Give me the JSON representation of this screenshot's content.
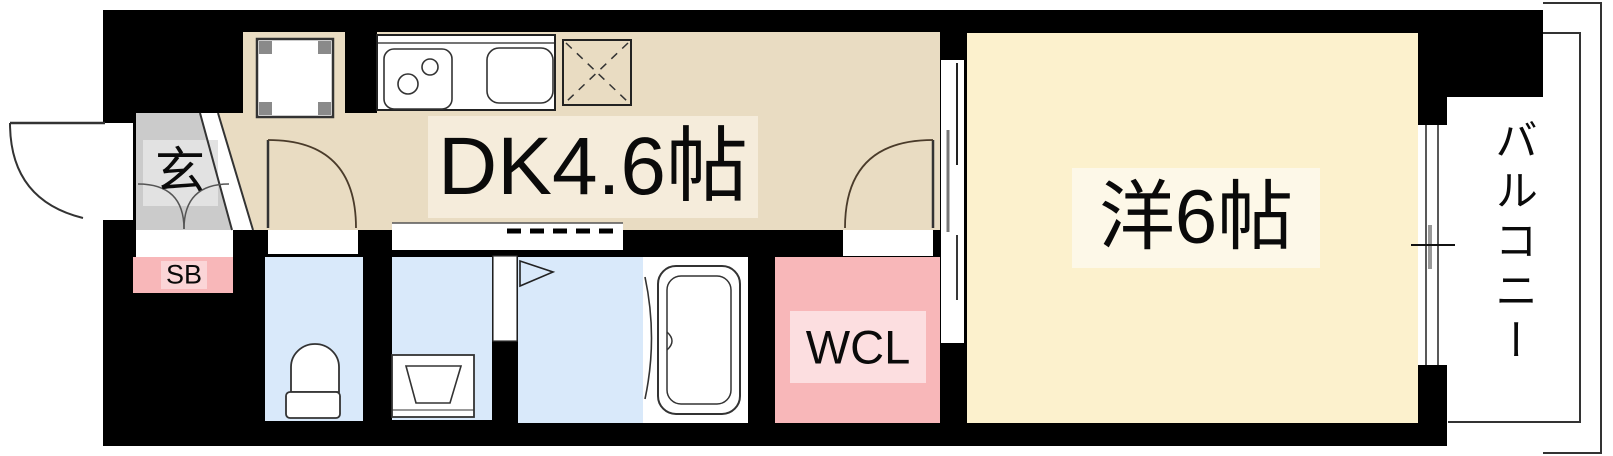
{
  "plan_title": "1DK apartment floor plan",
  "rooms": {
    "genkan": {
      "label": "玄"
    },
    "shoe_box": {
      "label": "SB"
    },
    "dk": {
      "label": "DK4.6帖"
    },
    "wcl": {
      "label": "WCL"
    },
    "western": {
      "label": "洋6帖"
    },
    "balcony": {
      "label": "バルコニー"
    }
  },
  "colors": {
    "wall": "#000000",
    "dk_floor": "#e9dcc2",
    "dk_label_bg": "#f5ecdb",
    "western_floor": "#fcf1cd",
    "western_label_bg": "#fdf8e8",
    "wet_room_floor": "#d9e9fa",
    "genkan_floor": "#cbcbcb",
    "genkan_label_bg": "#e2e2e2",
    "closet_pink": "#f8b7b9",
    "wcl_label_bg": "#fcdee0",
    "sb_label_bg": "#fbd5d7",
    "line": "#333333",
    "white": "#ffffff"
  },
  "fixtures": [
    "entrance-door-swing",
    "genkan-step-curves",
    "washing-machine-space",
    "gas-stove",
    "kitchen-sink",
    "refrigerator-space",
    "interior-door-swing",
    "toilet",
    "washbasin",
    "bath-folding-door",
    "bathtub",
    "room-door-swing",
    "sliding-door",
    "window",
    "balcony-railing",
    "soffit-dashed-line"
  ]
}
